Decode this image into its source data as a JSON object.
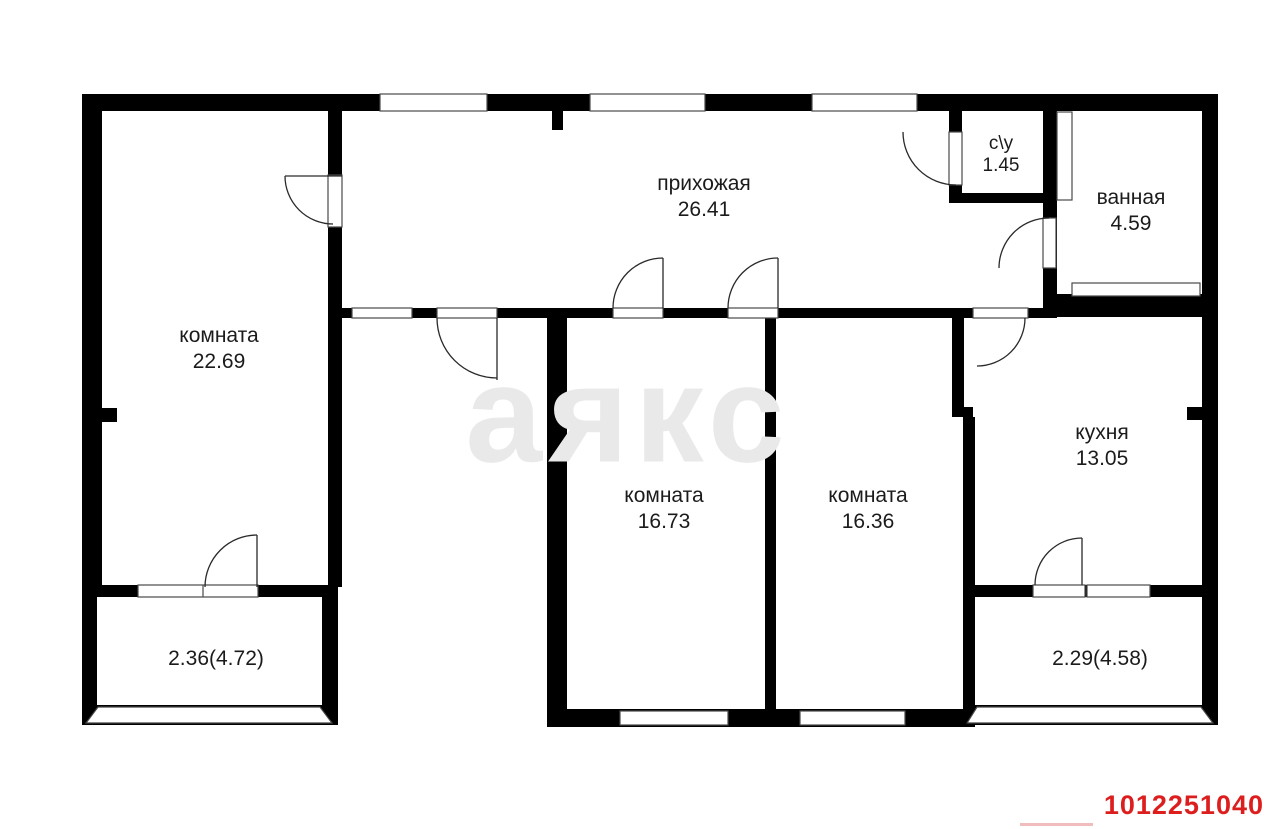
{
  "plan": {
    "title": "apartment floor plan",
    "rooms": [
      {
        "id": "hallway",
        "name": "прихожая",
        "area": "26.41"
      },
      {
        "id": "room-large",
        "name": "комната",
        "area": "22.69"
      },
      {
        "id": "wc",
        "name": "с\\у",
        "area": "1.45"
      },
      {
        "id": "bathroom",
        "name": "ванная",
        "area": "4.59"
      },
      {
        "id": "kitchen",
        "name": "кухня",
        "area": "13.05"
      },
      {
        "id": "room-middle",
        "name": "комната",
        "area": "16.73"
      },
      {
        "id": "room-right",
        "name": "комната",
        "area": "16.36"
      },
      {
        "id": "balcony-left",
        "area": "2.36(4.72)"
      },
      {
        "id": "balcony-right",
        "area": "2.29(4.58)"
      }
    ],
    "watermark": "аякс",
    "listing_id": "1012251040",
    "colors": {
      "walls": "#000000",
      "watermark": "#e9e9e9",
      "listing_id": "#dd1e1e"
    }
  }
}
